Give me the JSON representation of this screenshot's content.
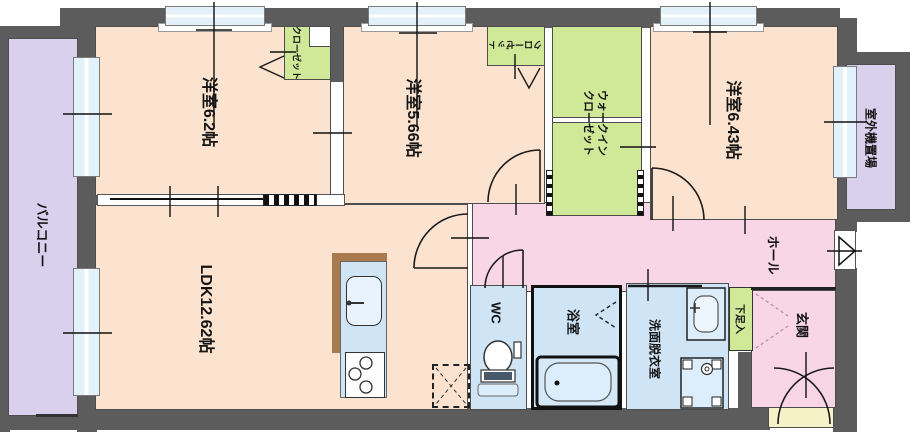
{
  "rooms": {
    "balcony": {
      "label": "バルコニー"
    },
    "bedroom1": {
      "label": "洋室6.2帖"
    },
    "closet1": {
      "label": "クローゼット"
    },
    "bedroom2": {
      "label": "洋室5.66帖"
    },
    "closet2": {
      "label": "クローゼット"
    },
    "wic": {
      "label_line1": "ウォークイン",
      "label_line2": "クローゼット"
    },
    "bedroom3": {
      "label": "洋室6.43帖"
    },
    "outdoor_unit": {
      "label": "室外機置場"
    },
    "ldk": {
      "label": "LDK12.62帖"
    },
    "hall": {
      "label": "ホール"
    },
    "wc": {
      "label": "WC"
    },
    "bath": {
      "label": "浴室"
    },
    "washroom": {
      "label": "洗面脱衣室"
    },
    "shoe_box": {
      "label": "下足入"
    },
    "entrance": {
      "label": "玄関"
    }
  },
  "colors": {
    "wall": "#5c5c5c",
    "room_floor_peach": "#fbe3cf",
    "closet_green": "#cfe998",
    "hall_pink": "#f9d6e6",
    "wet_area_blue": "#cfe4f5",
    "balcony_purple": "#d8d0ec",
    "porch_yellow": "#f6f2c8",
    "window_glass": "#e3f2fa",
    "counter_brown": "#a87a4e"
  },
  "fixtures": [
    "kitchen-sink",
    "gas-stove",
    "refrigerator-space",
    "toilet",
    "bathtub",
    "washbasin",
    "washing-machine-pan"
  ]
}
